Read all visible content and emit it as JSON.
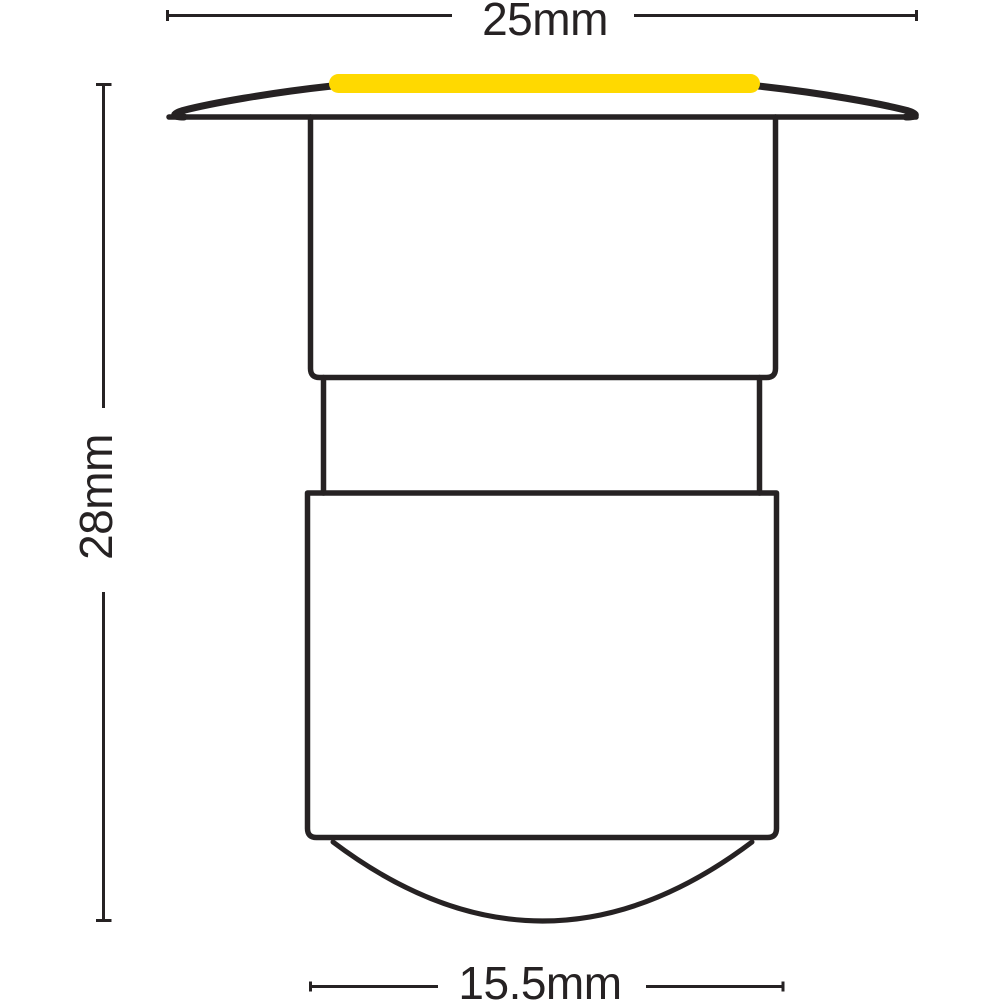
{
  "page": {
    "description": "Technical dimension diagram, side elevation of a recessed LED plinth/deck light fixture"
  },
  "colors": {
    "ink": "#262223",
    "accent": "#FFD900",
    "page_background": "#FFFFFF"
  },
  "dimensions": {
    "top_width": {
      "label": "25mm"
    },
    "left_height": {
      "label": "28mm"
    },
    "bottom_width": {
      "label": "15.5mm"
    }
  },
  "parts": {
    "led_strip": "yellow LED light strip",
    "flange": "top trim flange",
    "upper_body": "upper housing section",
    "neck": "recessed neck section",
    "lower_body": "lower housing section",
    "dome": "bottom diffuser dome"
  }
}
